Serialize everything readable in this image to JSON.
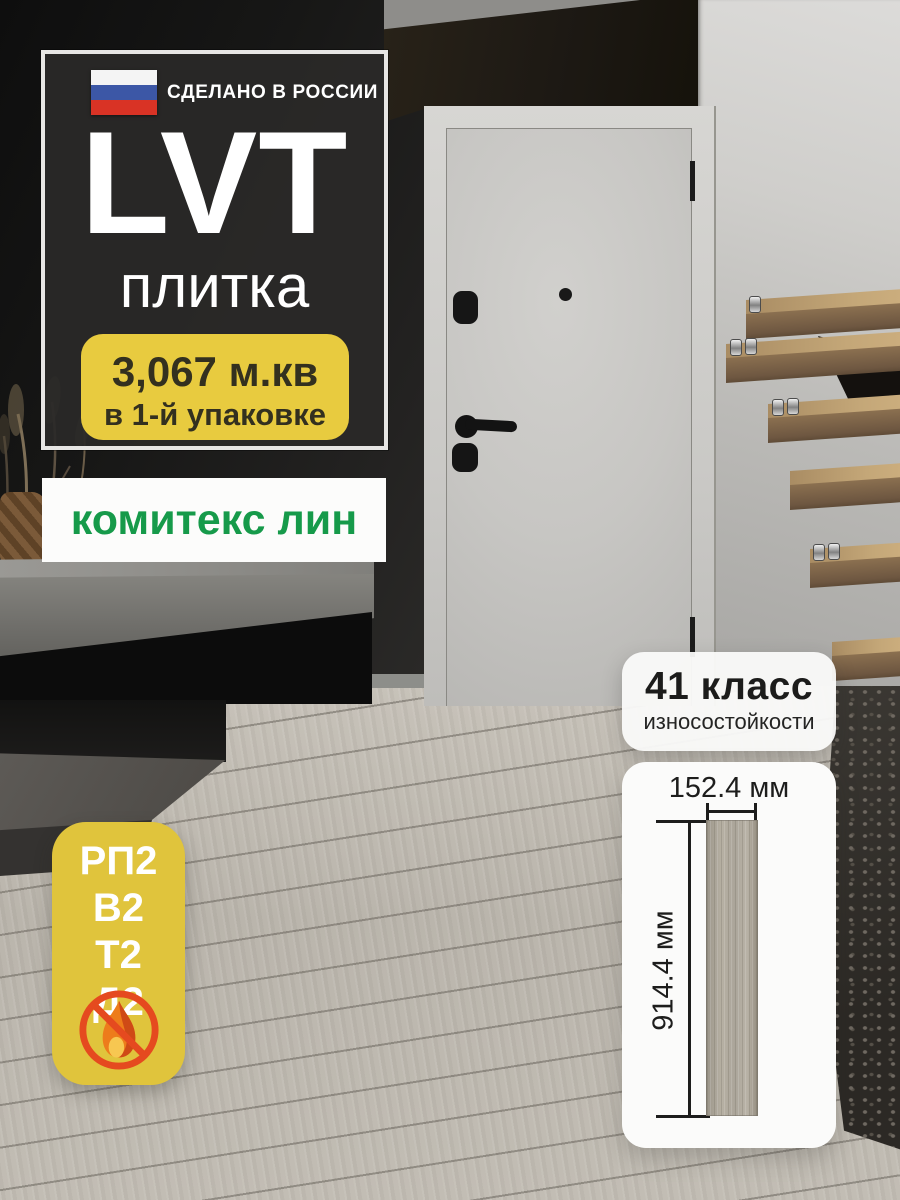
{
  "main_badge": {
    "made_in": "СДЕЛАНО В РОССИИ",
    "title": "LVT",
    "subtitle": "плитка",
    "pack_line1": "3,067 м.кв",
    "pack_line2": "в 1-й упаковке"
  },
  "brand": {
    "logo_text": "комитекс лин"
  },
  "wear_badge": {
    "line1": "41 класс",
    "line2": "износостойкости"
  },
  "dimensions": {
    "width_label": "152.4 мм",
    "height_label": "914.4 мм"
  },
  "props_badge": {
    "items": [
      "РП2",
      "В2",
      "Т2",
      "Д2"
    ],
    "icon": "no-fire-icon"
  },
  "icons": {
    "flag": "russia-flag-icon",
    "no_fire": "no-fire-icon"
  },
  "colors": {
    "accent_yellow": "#e8cb3f",
    "brand_green": "#169a4a",
    "flag_blue": "#3c57a6",
    "flag_red": "#d93325",
    "alert_orange": "#e54a1f",
    "card_dark": "#2a2928"
  }
}
